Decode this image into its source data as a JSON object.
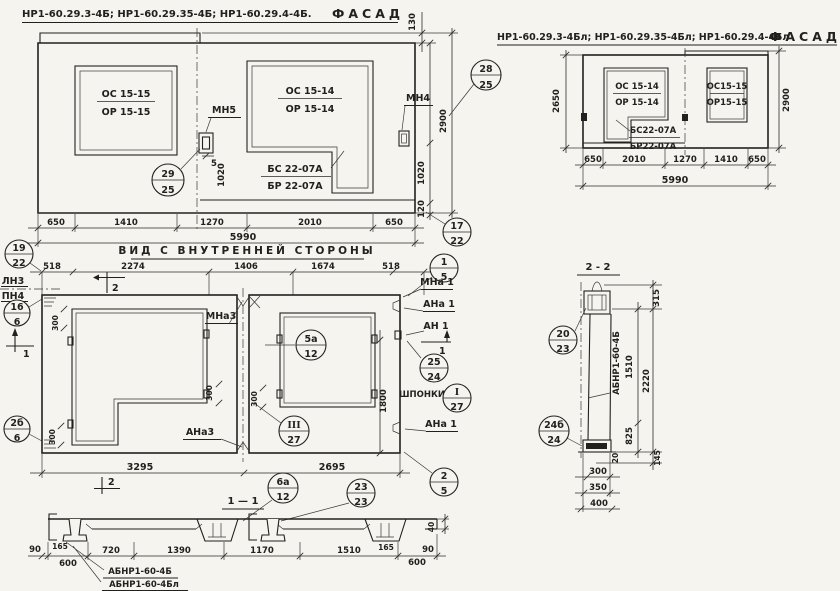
{
  "palette": {
    "paper": "#f5f4ef",
    "ink": "#22211f"
  },
  "facade_left": {
    "title": "НР1-60.29.3-4Б; НР1-60.29.35-4Б; НР1-60.29.4-4Б.",
    "fasad": "ФАСАД",
    "win1_top": "ОС 15-15",
    "win1_bot": "ОР 15-15",
    "win2_top": "ОС 15-14",
    "win2_bot": "ОР 15-14",
    "block_top": "БС 22-07А",
    "block_bot": "БР 22-07А",
    "anchor_mid": "МН5",
    "anchor_right": "МН4",
    "dim_joint": "5",
    "dims_bottom": [
      "650",
      "1410",
      "1270",
      "2010",
      "650"
    ],
    "dim_total": "5990",
    "dim_strip": "130",
    "dim_height": "2900",
    "dim_1020_left": "1020",
    "dim_1020_right": "1020",
    "dim_120": "120",
    "callout_joint": {
      "top": "29",
      "bot": "25"
    },
    "callout_top": {
      "top": "28",
      "bot": "25"
    },
    "callout_corner": {
      "top": "17",
      "bot": "22"
    }
  },
  "facade_right": {
    "title": "НР1-60.29.3-4Бл; НР1-60.29.35-4Бл; НР1-60.29.4-4Бл",
    "fasad": "ФАСАД",
    "win1_top": "ОС 15-14",
    "win1_bot": "ОР 15-14",
    "win2_top": "ОС15-15",
    "win2_bot": "ОР15-15",
    "block_top": "БС22-07А",
    "block_bot": "БР22-07А",
    "dims_bottom": [
      "650",
      "2010",
      "1270",
      "1410",
      "650"
    ],
    "dim_total": "5990",
    "dim_height_left": "2650",
    "dim_height_right": "2900"
  },
  "interior": {
    "title": "ВИД С ВНУТРЕННЕЙ СТОРОНЫ",
    "dims_top": [
      "518",
      "2274",
      "1406",
      "1674",
      "518"
    ],
    "row_label_top": "ЛН3",
    "row_label_bot": "ПН4",
    "label_mna3": "МНа3",
    "label_ana3": "АНа3",
    "label_mna1": "МНа 1",
    "label_ana1_top": "АНа 1",
    "label_an1": "АН 1",
    "label_ana1_bot": "АНа 1",
    "label_shponki": "ШПОНКИ",
    "dim_left_panel": "3295",
    "dim_right_panel": "2695",
    "dim_1800": "1800",
    "dim_300_a": "300",
    "dim_300_b": "300",
    "dim_300_c": "300",
    "dim_300_d": "300",
    "marker_2_top": "2",
    "marker_2_bot": "2",
    "marker_1_left": "1",
    "marker_1_right": "1",
    "callout_19_22": {
      "top": "19",
      "bot": "22"
    },
    "callout_16_6": {
      "top": "16",
      "bot": "6"
    },
    "callout_2b_6": {
      "top": "2б",
      "bot": "6"
    },
    "callout_1_5": {
      "top": "1",
      "bot": "5"
    },
    "callout_2_5": {
      "top": "2",
      "bot": "5"
    },
    "callout_5a_12": {
      "top": "5а",
      "bot": "12"
    },
    "callout_25_24": {
      "top": "25",
      "bot": "24"
    },
    "callout_I_27": {
      "top": "I",
      "bot": "27"
    },
    "callout_III_27": {
      "top": "III",
      "bot": "27"
    }
  },
  "section22": {
    "title": "2 - 2",
    "panel_mark": "АБНР1-60-4Б",
    "dim_315": "315",
    "dim_1510": "1510",
    "dim_2220": "2220",
    "dim_825": "825",
    "dim_20": "20",
    "dim_145": "145",
    "dim_300": "300",
    "dim_350": "350",
    "dim_400": "400",
    "callout_20_23": {
      "top": "20",
      "bot": "23"
    },
    "callout_24b_24": {
      "top": "24б",
      "bot": "24"
    }
  },
  "section11": {
    "title": "1 — 1",
    "dims": [
      "600",
      "720",
      "1390",
      "1170",
      "1510",
      "600"
    ],
    "dim_90_left": "90",
    "dim_90_right": "90",
    "dim_165_left": "165",
    "dim_165_right": "165",
    "dim_40": "40",
    "label_a": "АБНР1-60-4Б",
    "label_b": "АБНР1-60-4Бл",
    "callout_6a_12": {
      "top": "6а",
      "bot": "12"
    },
    "callout_23_23": {
      "top": "23",
      "bot": "23"
    }
  }
}
